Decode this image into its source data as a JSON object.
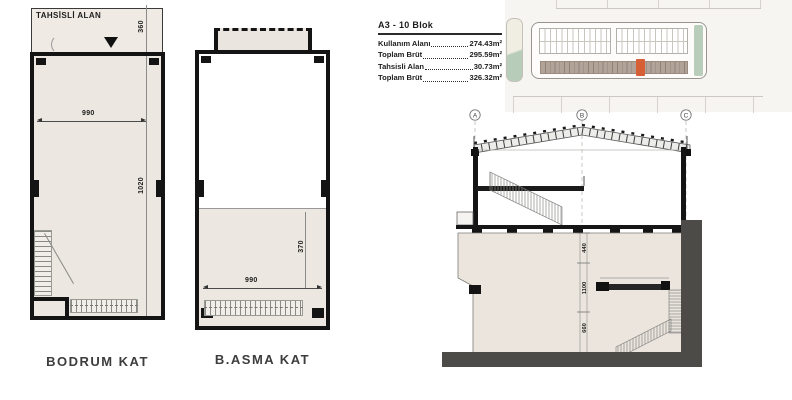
{
  "plans": {
    "bodrum": {
      "area_label": "TAHSİSLİ ALAN",
      "name": "BODRUM KAT",
      "dim_width": "990",
      "dim_height": "1020",
      "dim_top": "360"
    },
    "asma": {
      "name": "B.ASMA KAT",
      "dim_width": "990",
      "dim_height": "370"
    }
  },
  "info_panel": {
    "title": "A3 - 10 Blok",
    "rows": [
      {
        "label": "Kullanım Alanı",
        "value": "274.43m²"
      },
      {
        "label": "Toplam Brüt",
        "value": "295.59m²"
      },
      {
        "label": "Tahsisli Alan",
        "value": "30.73m²"
      },
      {
        "label": "Toplam Brüt",
        "value": "326.32m²"
      }
    ]
  },
  "section": {
    "grid_labels": [
      "A",
      "B",
      "C"
    ],
    "dims": [
      "440",
      "1100",
      "660"
    ]
  },
  "site_plan": {
    "highlight_color": "#d65f35",
    "green_color": "#b9ceba",
    "brown_color": "#b2a399"
  }
}
